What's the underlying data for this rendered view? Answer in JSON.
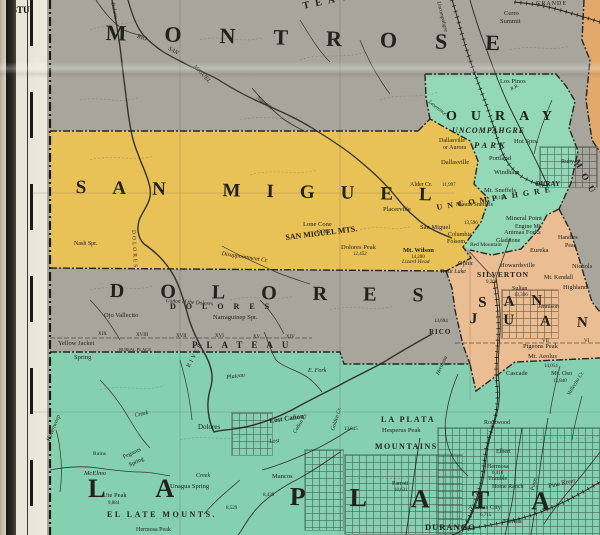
{
  "map": {
    "description": "Vintage county map, southwestern Colorado at Utah border",
    "base_color": "#a7a59c",
    "line_color": "#34332c",
    "counties": [
      {
        "id": "san_miguel",
        "name": "SAN MIGUEL",
        "color": "#e9c257"
      },
      {
        "id": "ouray",
        "name": "OURAY",
        "color": "#93d8b7"
      },
      {
        "id": "san_juan",
        "name": "SAN JUAN",
        "color": "#eabd92"
      },
      {
        "id": "la_plata",
        "name": "LA PLATA",
        "color": "#84d0b0"
      },
      {
        "id": "montrose",
        "name": "MONTROSE",
        "color": "#a7a59c"
      },
      {
        "id": "dolores",
        "name": "DOLORES",
        "color": "#a7a59c"
      },
      {
        "id": "edge_orange",
        "name": "adjoining county (map edge)",
        "color": "#e3a86b"
      }
    ],
    "margin": {
      "grid_letters": [
        {
          "t": "P",
          "y": 22
        },
        {
          "t": "R",
          "y": 142
        },
        {
          "t": "S",
          "y": 212
        },
        {
          "t": "T",
          "y": 293
        },
        {
          "t": "U",
          "y": 360
        },
        {
          "t": "V",
          "y": 436
        },
        {
          "t": "W",
          "y": 500
        }
      ],
      "border_letters": [
        {
          "t": "T",
          "y": 10
        },
        {
          "t": "U",
          "y": 45
        },
        {
          "t": "I",
          "y": 80
        },
        {
          "t": "P",
          "y": 102
        },
        {
          "t": "N",
          "y": 147
        },
        {
          "t": "O",
          "y": 217
        },
        {
          "t": "R",
          "y": 287
        },
        {
          "t": "I",
          "y": 347
        },
        {
          "t": "E",
          "y": 397
        },
        {
          "t": "N",
          "y": 447
        },
        {
          "t": "A",
          "y": 497
        }
      ],
      "latitudes": [
        {
          "t": "38°",
          "y": 186
        },
        {
          "t": "37°30'",
          "y": 405
        }
      ]
    }
  },
  "labels": [
    {
      "t": "MONTROSE",
      "x": 106,
      "y": 22,
      "fs": 22,
      "ls": 38,
      "b": 1,
      "rot": 1.5
    },
    {
      "t": "SAN MIGUEL",
      "x": 76,
      "y": 178,
      "fs": 19,
      "ls": 26,
      "b": 1,
      "rot": 1.2
    },
    {
      "t": "DOLORES",
      "x": 110,
      "y": 281,
      "fs": 20,
      "ls": 36,
      "b": 1,
      "rot": 0.8
    },
    {
      "t": "OURAY",
      "x": 446,
      "y": 110,
      "fs": 14,
      "ls": 14,
      "b": 1
    },
    {
      "t": "UNCOMPAHGRE",
      "x": 452,
      "y": 127,
      "fs": 8,
      "ls": 1,
      "b": 1,
      "i": 1
    },
    {
      "t": "PARK",
      "x": 474,
      "y": 141,
      "fs": 8.5,
      "ls": 3,
      "b": 1,
      "i": 1
    },
    {
      "t": "SAN",
      "x": 478,
      "y": 296,
      "fs": 15,
      "ls": 17,
      "b": 1,
      "rot": -2
    },
    {
      "t": "JUAN",
      "x": 470,
      "y": 312,
      "fs": 15,
      "ls": 26,
      "b": 1,
      "rot": 2
    },
    {
      "t": "LA",
      "x": 88,
      "y": 476,
      "fs": 26,
      "ls": 50,
      "b": 1
    },
    {
      "t": "PLATA",
      "x": 290,
      "y": 484,
      "fs": 26,
      "ls": 44,
      "b": 1,
      "rot": 1
    },
    {
      "t": "UNCOMPAHGRE",
      "x": 436,
      "y": 204,
      "fs": 8,
      "ls": 5,
      "b": 1,
      "rot": -9
    },
    {
      "t": "MOU",
      "x": 580,
      "y": 158,
      "fs": 9,
      "ls": 7,
      "b": 1,
      "rot": 62
    },
    {
      "t": "TEAU",
      "x": 302,
      "y": 2,
      "fs": 10,
      "ls": 6,
      "b": 1,
      "rot": -12
    },
    {
      "t": "EL LATE MOUNTS.",
      "x": 107,
      "y": 511,
      "fs": 8,
      "ls": 2.5,
      "b": 1
    },
    {
      "t": "SAN MIGUEL MTS.",
      "x": 285,
      "y": 234,
      "fs": 8,
      "b": 1,
      "rot": -7
    },
    {
      "t": "DOLORES",
      "x": 170,
      "y": 303,
      "fs": 8,
      "ls": 10,
      "b": 1
    },
    {
      "t": "PLATEAU",
      "x": 192,
      "y": 341,
      "fs": 9,
      "ls": 9,
      "b": 1
    },
    {
      "t": "LA PLATA",
      "x": 381,
      "y": 416,
      "fs": 8,
      "ls": 2,
      "b": 1
    },
    {
      "t": "MOUNTAINS",
      "x": 375,
      "y": 443,
      "fs": 8,
      "ls": 1.5,
      "b": 1
    },
    {
      "t": "SILVERTON",
      "x": 477,
      "y": 271,
      "fs": 7.5,
      "ls": 1,
      "b": 1
    },
    {
      "t": "DURANGO",
      "x": 425,
      "y": 523,
      "fs": 8.5,
      "ls": 1,
      "b": 1
    },
    {
      "t": "RICO",
      "x": 429,
      "y": 329,
      "fs": 7,
      "ls": 1,
      "b": 1
    },
    {
      "t": "OURAY",
      "x": 535,
      "y": 181,
      "fs": 7,
      "b": 1
    },
    {
      "t": "Cerro",
      "x": 504,
      "y": 11,
      "fs": 6.5
    },
    {
      "t": "Summit",
      "x": 500,
      "y": 19,
      "fs": 6.5
    },
    {
      "t": "GRANDE",
      "x": 536,
      "y": 1,
      "fs": 6,
      "ls": 1
    },
    {
      "t": "Los Pinos",
      "x": 500,
      "y": 79,
      "fs": 6.5
    },
    {
      "t": "Hot Sprs.",
      "x": 514,
      "y": 139,
      "fs": 6.5
    },
    {
      "t": "Dallasville",
      "x": 439,
      "y": 138,
      "fs": 6
    },
    {
      "t": "or Aurora",
      "x": 443,
      "y": 145,
      "fs": 6
    },
    {
      "t": "Dallasville",
      "x": 441,
      "y": 160,
      "fs": 6.5
    },
    {
      "t": "Portland",
      "x": 489,
      "y": 156,
      "fs": 6.5
    },
    {
      "t": "Windham",
      "x": 494,
      "y": 170,
      "fs": 6.5
    },
    {
      "t": "Ruby",
      "x": 561,
      "y": 159,
      "fs": 6
    },
    {
      "t": "Mt. Sneffels",
      "x": 484,
      "y": 188,
      "fs": 6.5
    },
    {
      "t": "14,158",
      "x": 492,
      "y": 196,
      "fs": 5
    },
    {
      "t": "Mount Sneffels",
      "x": 456,
      "y": 202,
      "fs": 6
    },
    {
      "t": "13,596",
      "x": 464,
      "y": 221,
      "fs": 5
    },
    {
      "t": "Mineral Point",
      "x": 506,
      "y": 216,
      "fs": 6.5
    },
    {
      "t": "Engine Mt.",
      "x": 515,
      "y": 224,
      "fs": 6
    },
    {
      "t": "Animas Forks",
      "x": 504,
      "y": 230,
      "fs": 6.5
    },
    {
      "t": "Gladstone",
      "x": 496,
      "y": 238,
      "fs": 6
    },
    {
      "t": "Handies",
      "x": 558,
      "y": 235,
      "fs": 6
    },
    {
      "t": "Peak",
      "x": 565,
      "y": 243,
      "fs": 6
    },
    {
      "t": "Eureka",
      "x": 530,
      "y": 248,
      "fs": 6.5
    },
    {
      "t": "Howardsville",
      "x": 500,
      "y": 263,
      "fs": 6.5
    },
    {
      "t": "9,200",
      "x": 486,
      "y": 280,
      "fs": 5
    },
    {
      "t": "Sultan",
      "x": 512,
      "y": 286,
      "fs": 6
    },
    {
      "t": "13,336",
      "x": 514,
      "y": 293,
      "fs": 5
    },
    {
      "t": "Mt. Kendall",
      "x": 544,
      "y": 275,
      "fs": 6
    },
    {
      "t": "Nichols",
      "x": 572,
      "y": 264,
      "fs": 6.5
    },
    {
      "t": "Highland",
      "x": 563,
      "y": 285,
      "fs": 6.5
    },
    {
      "t": "Red Mountain",
      "x": 470,
      "y": 243,
      "fs": 5.5
    },
    {
      "t": "San Miguel",
      "x": 420,
      "y": 225,
      "fs": 6.5
    },
    {
      "t": "Columbia",
      "x": 448,
      "y": 232,
      "fs": 6
    },
    {
      "t": "Folsom",
      "x": 447,
      "y": 239,
      "fs": 6
    },
    {
      "t": "Mt. Wilson",
      "x": 403,
      "y": 248,
      "fs": 6.5,
      "b": 1
    },
    {
      "t": "14,280",
      "x": 411,
      "y": 255,
      "fs": 5
    },
    {
      "t": "Ophir",
      "x": 458,
      "y": 261,
      "fs": 6.5
    },
    {
      "t": "Trout Lake",
      "x": 440,
      "y": 269,
      "fs": 6,
      "i": 1
    },
    {
      "t": "Lizard Head",
      "x": 402,
      "y": 260,
      "fs": 5.5,
      "i": 1
    },
    {
      "t": "Placerville",
      "x": 383,
      "y": 207,
      "fs": 6.5
    },
    {
      "t": "Alder Cr.",
      "x": 410,
      "y": 182,
      "fs": 6
    },
    {
      "t": "11,997",
      "x": 442,
      "y": 183,
      "fs": 5
    },
    {
      "t": "Lone Cone",
      "x": 303,
      "y": 222,
      "fs": 6.5
    },
    {
      "t": "12,761",
      "x": 316,
      "y": 230,
      "fs": 5
    },
    {
      "t": "Dolores Peak",
      "x": 341,
      "y": 245,
      "fs": 6.5
    },
    {
      "t": "12,452",
      "x": 353,
      "y": 252,
      "fs": 5
    },
    {
      "t": "Nash Spr.",
      "x": 74,
      "y": 241,
      "fs": 6
    },
    {
      "t": "Disappointment Cr.",
      "x": 222,
      "y": 251,
      "fs": 6,
      "i": 1,
      "rot": 9
    },
    {
      "t": "Ojo Vallecito",
      "x": 104,
      "y": 313,
      "fs": 6.5
    },
    {
      "t": "Narraguinep Spr.",
      "x": 213,
      "y": 315,
      "fs": 6.5
    },
    {
      "t": "Yellow Jacket",
      "x": 58,
      "y": 341,
      "fs": 6.5
    },
    {
      "t": "Spring",
      "x": 74,
      "y": 355,
      "fs": 6.5
    },
    {
      "t": "BURIAL PLACE",
      "x": 119,
      "y": 348,
      "fs": 4.5
    },
    {
      "t": "XIX",
      "x": 98,
      "y": 332,
      "fs": 5
    },
    {
      "t": "XVIII",
      "x": 136,
      "y": 333,
      "fs": 5
    },
    {
      "t": "XVII",
      "x": 176,
      "y": 334,
      "fs": 5
    },
    {
      "t": "XVI",
      "x": 215,
      "y": 334,
      "fs": 5
    },
    {
      "t": "XV",
      "x": 253,
      "y": 335,
      "fs": 5
    },
    {
      "t": "XIV",
      "x": 286,
      "y": 335,
      "fs": 5
    },
    {
      "t": "13,694",
      "x": 434,
      "y": 319,
      "fs": 5
    },
    {
      "t": "E. Fork",
      "x": 308,
      "y": 368,
      "fs": 6,
      "i": 1
    },
    {
      "t": "Plateau",
      "x": 226,
      "y": 375,
      "fs": 6,
      "i": 1,
      "rot": -8
    },
    {
      "t": "RIVER",
      "x": 186,
      "y": 366,
      "fs": 6,
      "ls": 2,
      "rot": -62
    },
    {
      "t": "Creek",
      "x": 134,
      "y": 413,
      "fs": 6,
      "i": 1,
      "rot": -12
    },
    {
      "t": "Creek",
      "x": 196,
      "y": 473,
      "fs": 6,
      "i": 1
    },
    {
      "t": "Dolores",
      "x": 198,
      "y": 424,
      "fs": 7
    },
    {
      "t": "Lost Cañon",
      "x": 269,
      "y": 418,
      "fs": 7,
      "b": 1,
      "rot": -8
    },
    {
      "t": "Lost",
      "x": 269,
      "y": 439,
      "fs": 6,
      "i": 1,
      "rot": -5
    },
    {
      "t": "Cañon Cr.",
      "x": 293,
      "y": 432,
      "fs": 5.5,
      "i": 1,
      "rot": -58
    },
    {
      "t": "Golden Cr.",
      "x": 331,
      "y": 430,
      "fs": 5.5,
      "i": 1,
      "rot": -72
    },
    {
      "t": "Hovenweep",
      "x": 46,
      "y": 440,
      "fs": 6,
      "i": 1,
      "rot": -68
    },
    {
      "t": "Ruins",
      "x": 93,
      "y": 452,
      "fs": 5.5
    },
    {
      "t": "Pegasus",
      "x": 122,
      "y": 455,
      "fs": 6,
      "rot": -25
    },
    {
      "t": "Spring",
      "x": 128,
      "y": 463,
      "fs": 6,
      "rot": -25
    },
    {
      "t": "McElmo",
      "x": 84,
      "y": 471,
      "fs": 6.5,
      "i": 1
    },
    {
      "t": "Unagua Spring",
      "x": 170,
      "y": 484,
      "fs": 6.5
    },
    {
      "t": "Ute Peak",
      "x": 103,
      "y": 493,
      "fs": 6.5
    },
    {
      "t": "9,884",
      "x": 108,
      "y": 501,
      "fs": 5
    },
    {
      "t": "Mancos",
      "x": 272,
      "y": 474,
      "fs": 6.5
    },
    {
      "t": "8,439",
      "x": 263,
      "y": 493,
      "fs": 5
    },
    {
      "t": "8,529",
      "x": 226,
      "y": 506,
      "fs": 5
    },
    {
      "t": "Hesperus Peak",
      "x": 382,
      "y": 428,
      "fs": 6.5
    },
    {
      "t": "13,045",
      "x": 344,
      "y": 427,
      "fs": 5
    },
    {
      "t": "Parrott",
      "x": 392,
      "y": 481,
      "fs": 6
    },
    {
      "t": "10,631",
      "x": 394,
      "y": 488,
      "fs": 5
    },
    {
      "t": "Animas City",
      "x": 468,
      "y": 505,
      "fs": 6.5
    },
    {
      "t": "6,715",
      "x": 480,
      "y": 513,
      "fs": 5
    },
    {
      "t": "Florida",
      "x": 503,
      "y": 519,
      "fs": 6.5
    },
    {
      "t": "Pine River",
      "x": 548,
      "y": 484,
      "fs": 6.5,
      "rot": -12
    },
    {
      "t": "Pinos",
      "x": 531,
      "y": 490,
      "fs": 5.5,
      "i": 1,
      "rot": -78
    },
    {
      "t": "Rockwood",
      "x": 484,
      "y": 420,
      "fs": 6
    },
    {
      "t": "Elbert",
      "x": 496,
      "y": 449,
      "fs": 6
    },
    {
      "t": "Hermosa",
      "x": 487,
      "y": 464,
      "fs": 6
    },
    {
      "t": "6,418",
      "x": 492,
      "y": 471,
      "fs": 5
    },
    {
      "t": "Trimble",
      "x": 488,
      "y": 476,
      "fs": 6
    },
    {
      "t": "Home Ranch",
      "x": 492,
      "y": 484,
      "fs": 6
    },
    {
      "t": "Cascade",
      "x": 506,
      "y": 371,
      "fs": 6.5
    },
    {
      "t": "Pigeons Peak",
      "x": 523,
      "y": 344,
      "fs": 6.5
    },
    {
      "t": "Mt. Aeolus",
      "x": 528,
      "y": 354,
      "fs": 6.5
    },
    {
      "t": "14,054",
      "x": 544,
      "y": 364,
      "fs": 5
    },
    {
      "t": "Mt. Oso",
      "x": 551,
      "y": 371,
      "fs": 6.5
    },
    {
      "t": "13,840",
      "x": 553,
      "y": 379,
      "fs": 5
    },
    {
      "t": "Jennison",
      "x": 538,
      "y": 304,
      "fs": 6
    },
    {
      "t": "VII",
      "x": 542,
      "y": 339,
      "fs": 5
    },
    {
      "t": "VI",
      "x": 584,
      "y": 339,
      "fs": 5
    },
    {
      "t": "Hermosa",
      "x": 436,
      "y": 374,
      "fs": 5.5,
      "i": 1,
      "rot": -65
    },
    {
      "t": "Vallecito Cr.",
      "x": 567,
      "y": 394,
      "fs": 5.5,
      "i": 1,
      "rot": -58
    },
    {
      "t": "Uncompahgre",
      "x": 440,
      "y": 1,
      "fs": 5.5,
      "i": 1,
      "rot": 76
    },
    {
      "t": "RIO",
      "x": 138,
      "y": 34,
      "fs": 6,
      "i": 1,
      "rot": 18
    },
    {
      "t": "SAN",
      "x": 170,
      "y": 46,
      "fs": 6,
      "i": 1,
      "rot": 30
    },
    {
      "t": "MIGUEL",
      "x": 196,
      "y": 64,
      "fs": 6,
      "i": 1,
      "rot": 46
    },
    {
      "t": "Dolores",
      "x": 114,
      "y": 2,
      "fs": 5.5,
      "i": 1,
      "rot": 78
    },
    {
      "t": "Naturita",
      "x": 258,
      "y": 96,
      "fs": 5.5,
      "i": 1,
      "rot": 36
    },
    {
      "t": "R.R.",
      "x": 510,
      "y": 88,
      "fs": 5,
      "i": 1,
      "rot": -30
    },
    {
      "t": "Lawrence",
      "x": 430,
      "y": 100,
      "fs": 5.5,
      "i": 1,
      "rot": 38
    },
    {
      "t": "DOLORES",
      "x": 135,
      "y": 230,
      "fs": 5.5,
      "ls": 2,
      "rot": 87
    },
    {
      "t": "Cañon of the Dolores",
      "x": 166,
      "y": 299,
      "fs": 5.5,
      "i": 1,
      "rot": 4
    },
    {
      "t": "Hermosa Peak",
      "x": 136,
      "y": 527,
      "fs": 6
    }
  ]
}
